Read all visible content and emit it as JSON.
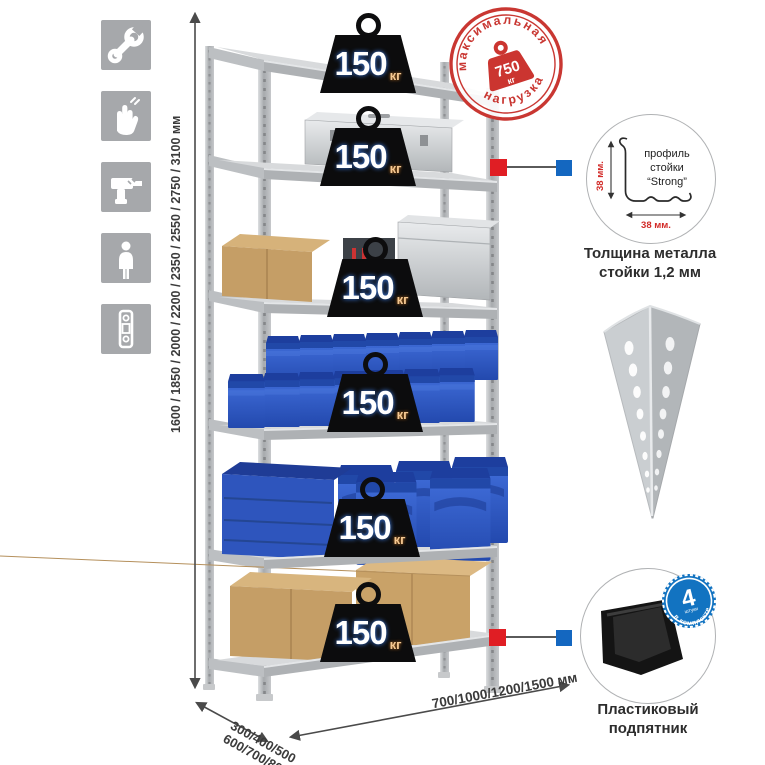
{
  "sidebar": {
    "icons": [
      {
        "name": "wrench-icon"
      },
      {
        "name": "gloves-icon"
      },
      {
        "name": "drill-icon"
      },
      {
        "name": "person-icon"
      },
      {
        "name": "level-icon"
      }
    ]
  },
  "rack": {
    "shelf_count": 6,
    "shelf_load": {
      "value": "150",
      "unit": "кг"
    }
  },
  "stamp": {
    "arc_top": "максимальная",
    "arc_bottom": "нагрузка",
    "value": "750",
    "unit": "кг"
  },
  "dimensions": {
    "height": "1600 / 1850 / 2000 / 2200 / 2350 / 2550 / 2750 / 3100 мм",
    "depth_line1": "300/400/500",
    "depth_line2": "600/700/800 мм",
    "width": "700/1000/1200/1500 мм"
  },
  "profile_detail": {
    "label_line1": "профиль",
    "label_line2": "стойки",
    "label_line3": "“Strong”",
    "dim_vertical": "38 мм.",
    "dim_horizontal": "38 мм.",
    "caption_line1": "Толщина металла",
    "caption_line2": "стойки 1,2 мм"
  },
  "foot_detail": {
    "badge_value": "4",
    "badge_sub": "штуки",
    "badge_arc": "в комплекте",
    "caption_line1": "Пластиковый",
    "caption_line2": "подпятник"
  },
  "colors": {
    "accent_red": "#cb3530",
    "accent_blue": "#1467c0",
    "bin_blue": "#2e5cc5",
    "metal_gray": "#b9bcbf"
  }
}
